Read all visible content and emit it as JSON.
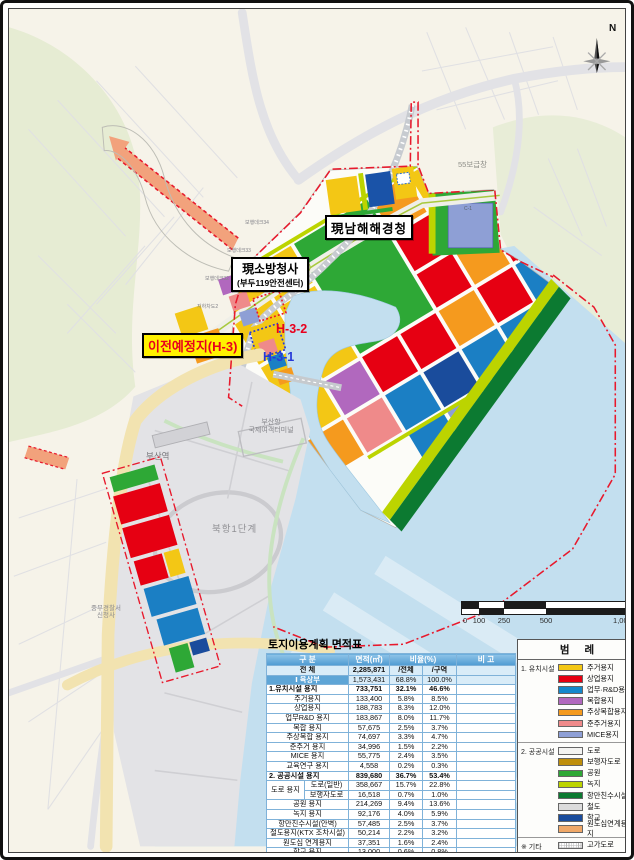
{
  "map": {
    "labels": {
      "north": "N",
      "agency": "現남해해경청",
      "fire_hq_line1": "現소방청사",
      "fire_hq_line2": "(부두119안전센터)",
      "relocation": "이전예정지(H-3)",
      "h32": "H-3-2",
      "h31": "H-3-1",
      "supply_depot": "55보급창",
      "busan_station": "부산역",
      "north_port": "북항1단계",
      "terminal_line1": "부산항",
      "terminal_line2": "국제여객터미널",
      "police_line1": "중부경찰서",
      "police_line2": "신청사",
      "deck34": "보행데크34",
      "deck33": "보행데크33",
      "deck32": "보행데크32",
      "underpass2": "지하차도2",
      "parcel_c1": "C-1"
    },
    "scale_bar": {
      "ticks": [
        "0",
        "100",
        "250",
        "500",
        "1,000"
      ]
    },
    "colors": {
      "sea": "#C3DFEF",
      "city": "#F6F3E9",
      "hill": "#E6ECD3",
      "pier": "#E3E3E6",
      "boundary_red": "#E8192C"
    }
  },
  "legend": {
    "title": "범 례",
    "sections": [
      {
        "name": "1. 유치시설",
        "items": [
          {
            "label": "주거용지",
            "color": "#F3C715"
          },
          {
            "label": "상업용지",
            "color": "#E60012"
          },
          {
            "label": "업무·R&D용지",
            "color": "#1488CC"
          },
          {
            "label": "복합용지",
            "color": "#B168BE"
          },
          {
            "label": "주상복합용지",
            "color": "#F59A1E"
          },
          {
            "label": "준주거용지",
            "color": "#EF8A8A"
          },
          {
            "label": "MICE용지",
            "color": "#8E9FD5"
          }
        ]
      },
      {
        "name": "2. 공공시설",
        "items": [
          {
            "label": "도로",
            "color": "#F4F4F2"
          },
          {
            "label": "보행자도로",
            "color": "#BE8E0C"
          },
          {
            "label": "공원",
            "color": "#2EA836"
          },
          {
            "label": "녹지",
            "color": "#BCD400"
          },
          {
            "label": "항만친수시설",
            "color": "#0C7A31"
          },
          {
            "label": "철도",
            "color": "#DCDCDC"
          },
          {
            "label": "학교",
            "color": "#1A4C9C"
          },
          {
            "label": "원도심연계용지",
            "color": "#F0A868"
          }
        ]
      },
      {
        "name": "※ 기타",
        "items": [
          {
            "label": "고가도로",
            "pattern": "dots"
          },
          {
            "label": "지하도로",
            "color": "#F6DCCB"
          },
          {
            "label": "보행데크",
            "color": "#EDE7D4"
          }
        ]
      }
    ]
  },
  "table": {
    "title": "토지이용계획 면적표",
    "headers": {
      "category": "구 분",
      "area": "면적(㎡)",
      "ratio": "비율(%)",
      "note": "비 고"
    },
    "rows": [
      {
        "style": "total",
        "label": "전 체",
        "area": "2,285,871",
        "pct_total": "/전체",
        "pct_zone": "/구역",
        "note": ""
      },
      {
        "style": "sec",
        "label": "Ⅰ 육상부",
        "area": "1,573,431",
        "pct_total": "68.8%",
        "pct_zone": "100.0%",
        "note": ""
      },
      {
        "style": "group",
        "label": "1.유치시설 용지",
        "area": "733,751",
        "pct_total": "32.1%",
        "pct_zone": "46.6%",
        "note": ""
      },
      {
        "style": "sub",
        "label": "주거용지",
        "area": "133,400",
        "pct_total": "5.8%",
        "pct_zone": "8.5%",
        "note": ""
      },
      {
        "style": "sub",
        "label": "상업용지",
        "area": "188,783",
        "pct_total": "8.3%",
        "pct_zone": "12.0%",
        "note": ""
      },
      {
        "style": "sub",
        "label": "업무R&D 용지",
        "area": "183,867",
        "pct_total": "8.0%",
        "pct_zone": "11.7%",
        "note": ""
      },
      {
        "style": "sub",
        "label": "복합 용지",
        "area": "57,675",
        "pct_total": "2.5%",
        "pct_zone": "3.7%",
        "note": ""
      },
      {
        "style": "sub",
        "label": "주상복합 용지",
        "area": "74,697",
        "pct_total": "3.3%",
        "pct_zone": "4.7%",
        "note": ""
      },
      {
        "style": "sub",
        "label": "준주거 용지",
        "area": "34,996",
        "pct_total": "1.5%",
        "pct_zone": "2.2%",
        "note": ""
      },
      {
        "style": "sub",
        "label": "MICE 용지",
        "area": "55,775",
        "pct_total": "2.4%",
        "pct_zone": "3.5%",
        "note": ""
      },
      {
        "style": "sub",
        "label": "교육연구 용지",
        "area": "4,558",
        "pct_total": "0.2%",
        "pct_zone": "0.3%",
        "note": ""
      },
      {
        "style": "group",
        "label": "2. 공공시설 용지",
        "area": "839,680",
        "pct_total": "36.7%",
        "pct_zone": "53.4%",
        "note": ""
      },
      {
        "style": "split1",
        "group": "도로 용지",
        "label": "도로(일반)",
        "area": "358,667",
        "pct_total": "15.7%",
        "pct_zone": "22.8%",
        "note": ""
      },
      {
        "style": "split2",
        "label": "보행자도로",
        "area": "16,518",
        "pct_total": "0.7%",
        "pct_zone": "1.0%",
        "note": ""
      },
      {
        "style": "sub",
        "label": "공원 용지",
        "area": "214,269",
        "pct_total": "9.4%",
        "pct_zone": "13.6%",
        "note": ""
      },
      {
        "style": "sub",
        "label": "녹지 용지",
        "area": "92,176",
        "pct_total": "4.0%",
        "pct_zone": "5.9%",
        "note": ""
      },
      {
        "style": "sub",
        "label": "항만친수시설(안벽)",
        "area": "57,485",
        "pct_total": "2.5%",
        "pct_zone": "3.7%",
        "note": ""
      },
      {
        "style": "sub",
        "label": "철도용지(KTX 조차시설)",
        "area": "50,214",
        "pct_total": "2.2%",
        "pct_zone": "3.2%",
        "note": ""
      },
      {
        "style": "sub",
        "label": "원도심 연계용지",
        "area": "37,351",
        "pct_total": "1.6%",
        "pct_zone": "2.4%",
        "note": ""
      },
      {
        "style": "sub",
        "label": "학교 용지",
        "area": "13,000",
        "pct_total": "0.6%",
        "pct_zone": "0.8%",
        "note": ""
      },
      {
        "style": "sec",
        "label": "Ⅱ 해상부(수역)",
        "area": "712,440",
        "pct_total": "31.2%",
        "pct_zone": "100.0%",
        "note": ""
      }
    ]
  }
}
